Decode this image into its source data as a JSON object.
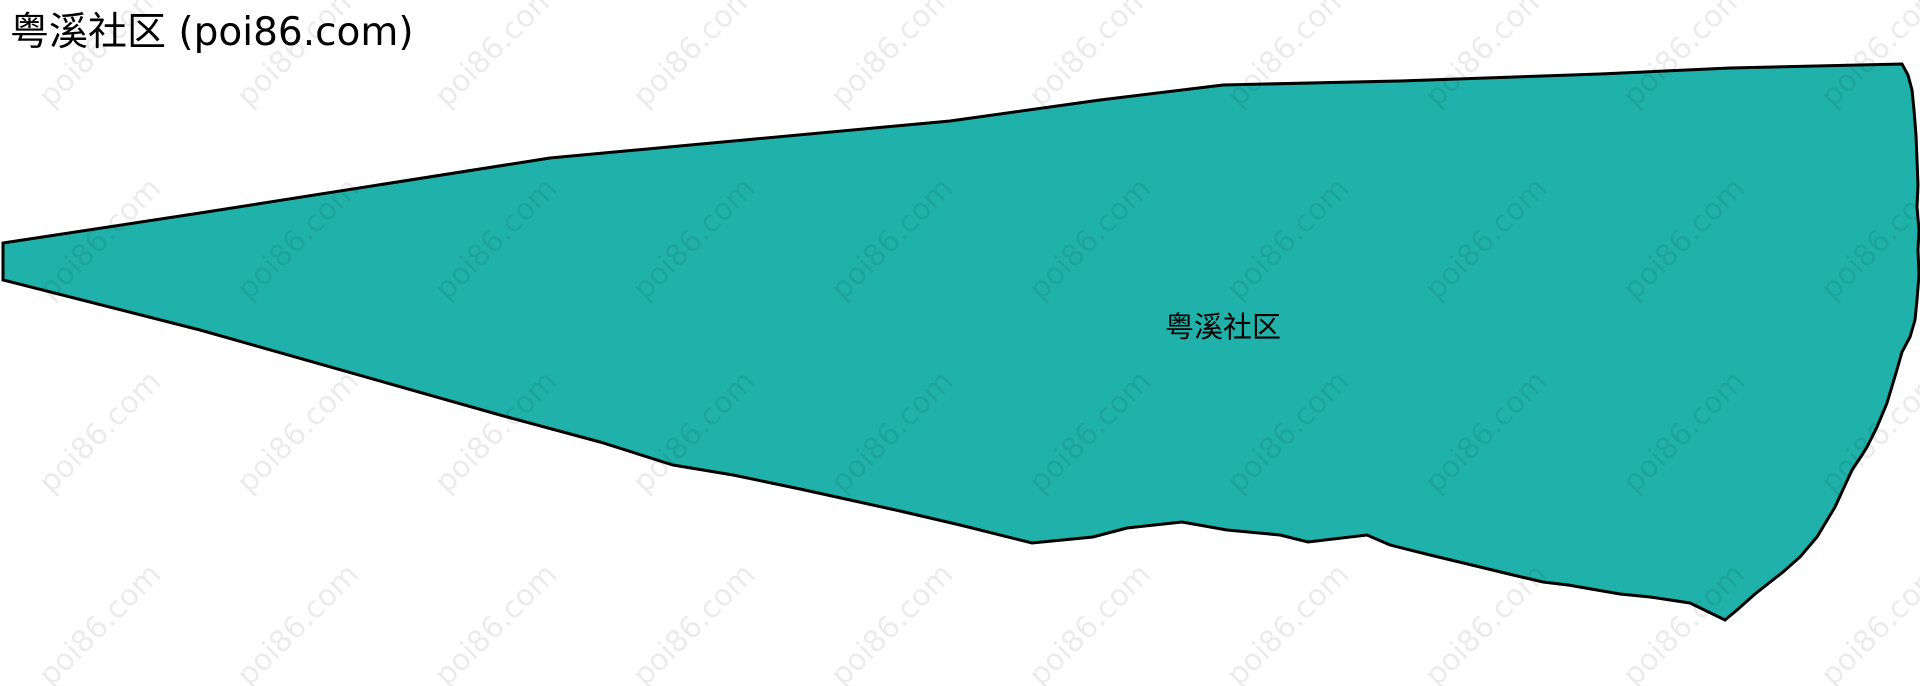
{
  "page": {
    "title": "粤溪社区 (poi86.com)",
    "background_color": "#ffffff"
  },
  "map": {
    "region_label": "粤溪社区",
    "region_fill": "#20b2aa",
    "region_stroke": "#000000",
    "polygon_points": "3,243 200,213 550,158 950,121 1100,100 1223,85 1400,81 1600,74 1730,68 1902,64 1908,75 1912,90 1914,110 1916,135 1917,160 1918,185 1917,207 1919,230 1918,250 1919,275 1917,300 1915,320 1910,337 1902,352 1896,373 1887,403 1877,427 1867,447 1862,455 1852,470 1835,507 1817,537 1800,557 1783,572 1755,594 1737,610 1725,620 1690,603 1650,597 1620,594 1568,585 1543,582 1513,575 1480,567 1430,555 1390,545 1367,535 1308,542 1280,535 1227,530 1182,522 1127,528 1093,537 1032,543 960,525 900,511 800,489 733,475 673,465 600,442 500,415 200,330 3,280"
  },
  "watermark": {
    "text": "poi86.com"
  }
}
